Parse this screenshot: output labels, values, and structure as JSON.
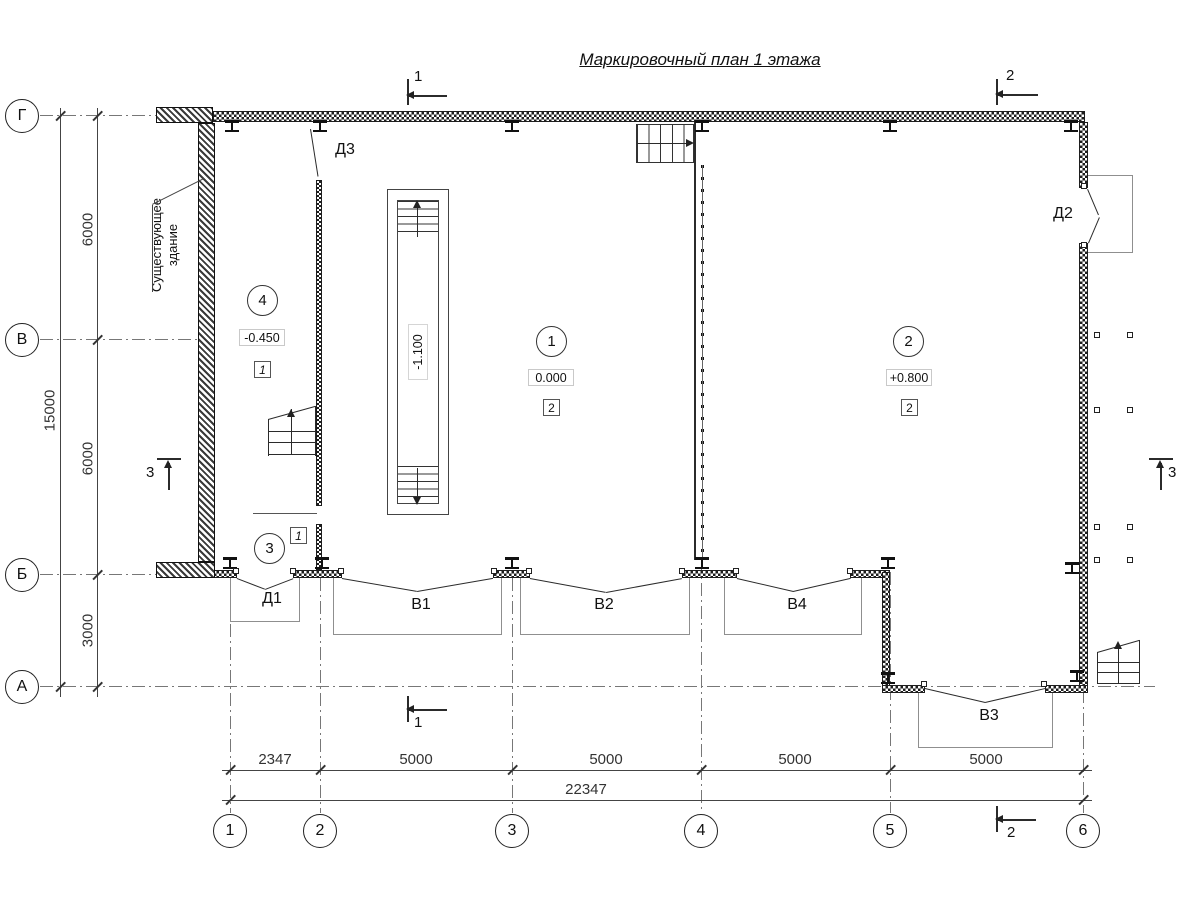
{
  "title": "Маркировочный план 1 этажа",
  "colors": {
    "line": "#2b2b2b",
    "gray_outline": "#8f8f8f",
    "dash": "#777777",
    "background": "#ffffff"
  },
  "row_axes": [
    {
      "label": "Г"
    },
    {
      "label": "В"
    },
    {
      "label": "Б"
    },
    {
      "label": "А"
    }
  ],
  "col_axes": [
    {
      "label": "1"
    },
    {
      "label": "2"
    },
    {
      "label": "3"
    },
    {
      "label": "4"
    },
    {
      "label": "5"
    },
    {
      "label": "6"
    }
  ],
  "dims": {
    "left_chain": [
      "6000",
      "6000",
      "3000"
    ],
    "left_total": "15000",
    "bottom_chain": [
      "2347",
      "5000",
      "5000",
      "5000",
      "5000"
    ],
    "bottom_total": "22347"
  },
  "rooms": [
    {
      "number": "4",
      "elevation": "-0.450",
      "type": "1"
    },
    {
      "number": "1",
      "elevation": "0.000",
      "type": "2"
    },
    {
      "number": "2",
      "elevation": "+0.800",
      "type": "2"
    },
    {
      "number": "3",
      "type": "1"
    }
  ],
  "ramp_elevation": "-1.100",
  "openings": {
    "d1": "Д1",
    "d2": "Д2",
    "d3": "Д3",
    "v1": "В1",
    "v2": "В2",
    "v3": "В3",
    "v4": "В4"
  },
  "section_marks": {
    "one": "1",
    "two": "2",
    "three": "3"
  },
  "annotation": {
    "line1": "Существующее",
    "line2": "здание"
  }
}
